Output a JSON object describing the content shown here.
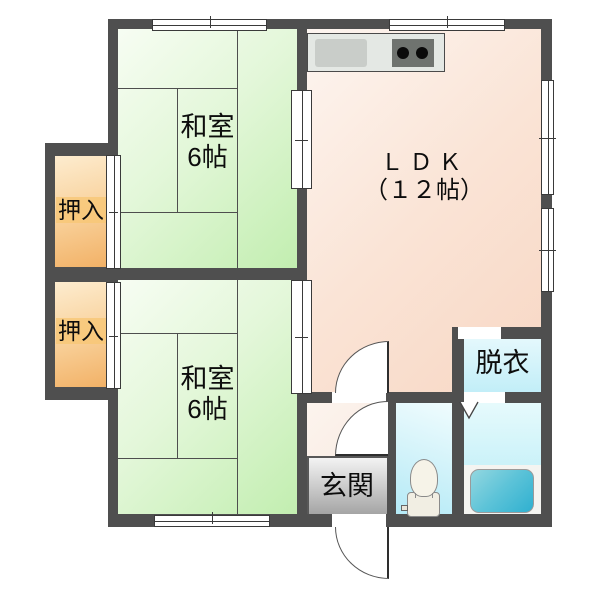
{
  "plan": {
    "rooms": {
      "washitsu1": {
        "name": "和室",
        "size": "6帖"
      },
      "washitsu2": {
        "name": "和室",
        "size": "6帖"
      },
      "ldk": {
        "name": "ＬＤＫ",
        "size": "（１２帖）"
      },
      "closet1": {
        "label": "押入"
      },
      "closet2": {
        "label": "押入"
      },
      "entrance": {
        "label": "玄関"
      },
      "dressing": {
        "label": "脱衣"
      }
    },
    "fixtures": [
      "kitchen-sink",
      "stove-2-burner",
      "toilet",
      "bathtub"
    ],
    "colors": {
      "wall": "#4f4f4f",
      "tatami_green": "#c2eeb0",
      "ldk_pink": "#f8d7c4",
      "closet_orange": "#f2b166",
      "water_cyan": "#b4eaf7",
      "bathtub_teal": "#2fb0d0",
      "entrance_gray": "#a2a2a2"
    }
  }
}
